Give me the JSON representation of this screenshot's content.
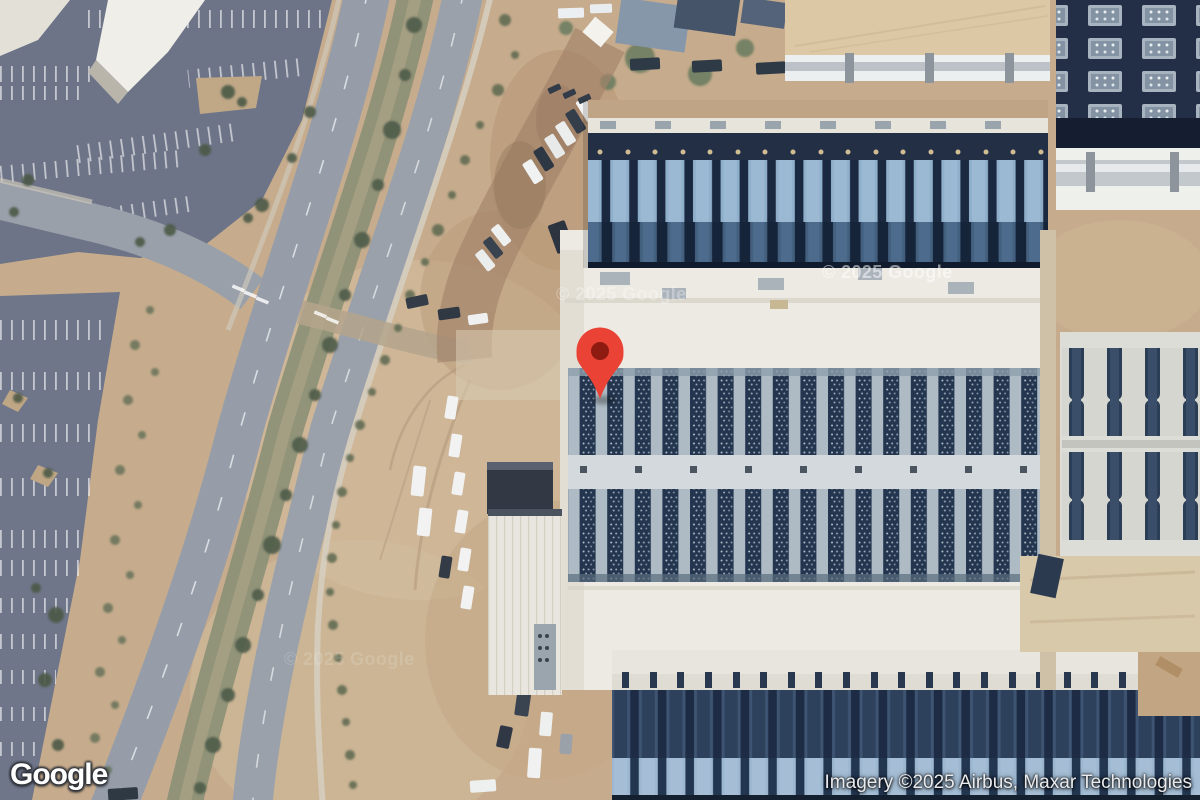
{
  "map": {
    "logo": "Google",
    "attribution": "Imagery ©2025 Airbus, Maxar Technologies",
    "watermarks": [
      "© 2025 Google",
      "© 2025 Google",
      "© 2025 Google"
    ],
    "marker": {
      "color": "#EA4335",
      "inner_color": "#8E1B12"
    }
  }
}
